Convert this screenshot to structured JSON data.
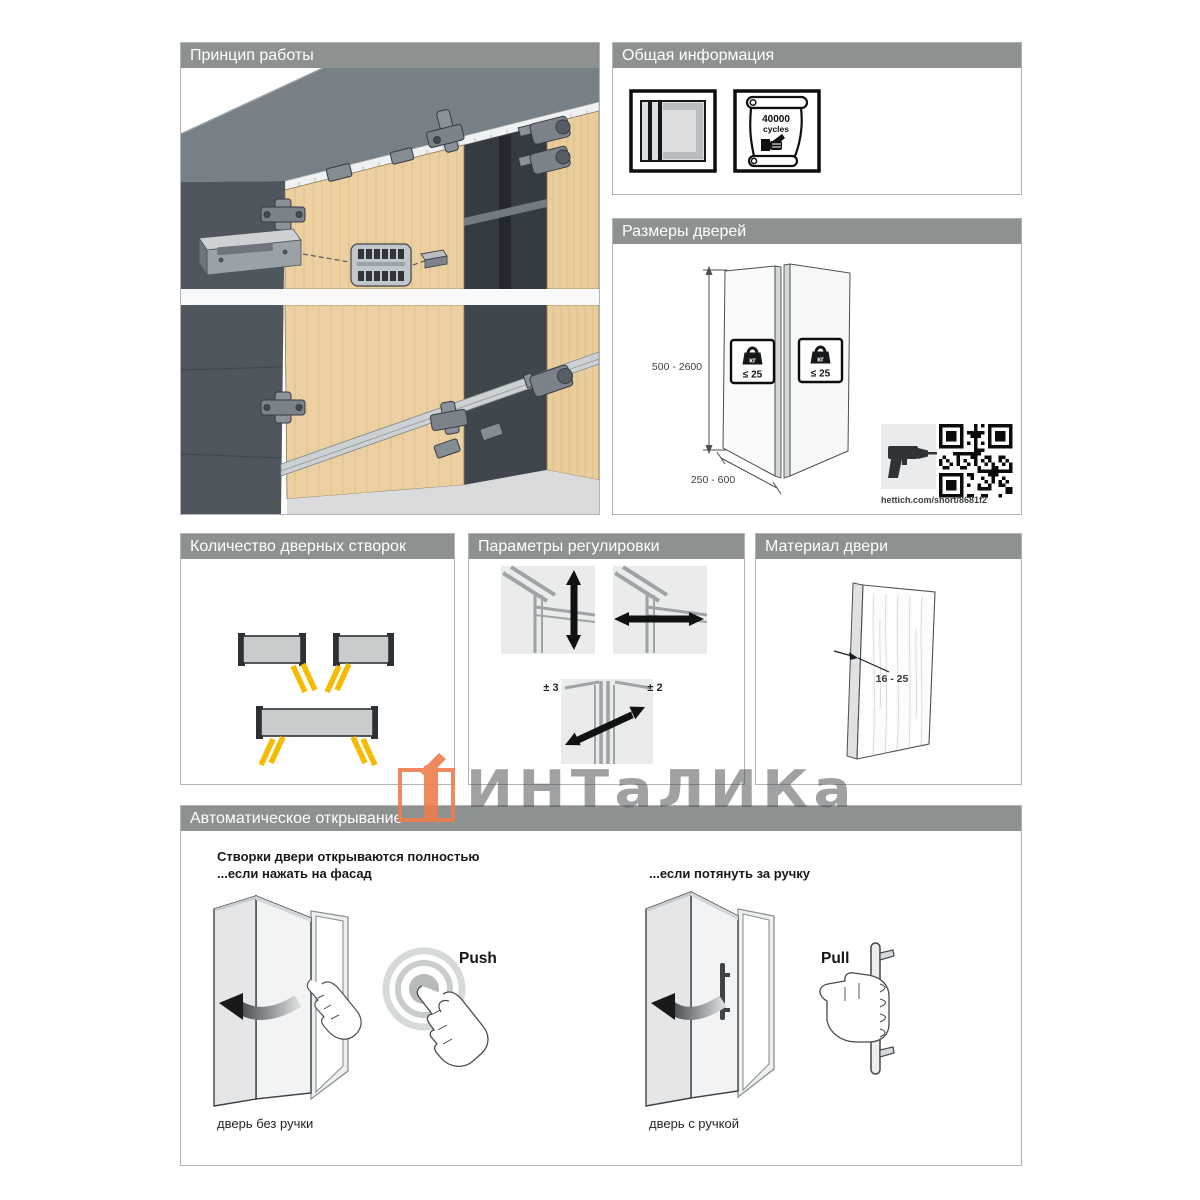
{
  "watermark": {
    "brand_text": "ИНТаЛИКа"
  },
  "panels": {
    "principle": {
      "title": "Принцип работы"
    },
    "general": {
      "title": "Общая информация",
      "cycles_value": "40000",
      "cycles_word": "cycles"
    },
    "dimensions": {
      "title": "Размеры дверей",
      "door_height_range": "500 - 2600",
      "door_width_range": "250 - 600",
      "weight_unit": "кг",
      "weight_limit": "≤ 25",
      "link_caption": "hettich.com/short/8681f2"
    },
    "leaf_count": {
      "title": "Количество дверных створок"
    },
    "adjustment": {
      "title": "Параметры регулировки",
      "values": [
        "± 3",
        "± 2",
        "± 2"
      ]
    },
    "material": {
      "title": "Материал двери",
      "thickness_range": "16 - 25"
    },
    "auto_open": {
      "title": "Автоматическое открывание",
      "intro_line1": "Створки двери открываются полностью",
      "intro_line2": "...если нажать на фасад",
      "pull_intro": "...если потянуть за ручку",
      "push_label": "Push",
      "pull_label": "Pull",
      "push_caption": "дверь без ручки",
      "pull_caption": "дверь с ручкой"
    }
  }
}
